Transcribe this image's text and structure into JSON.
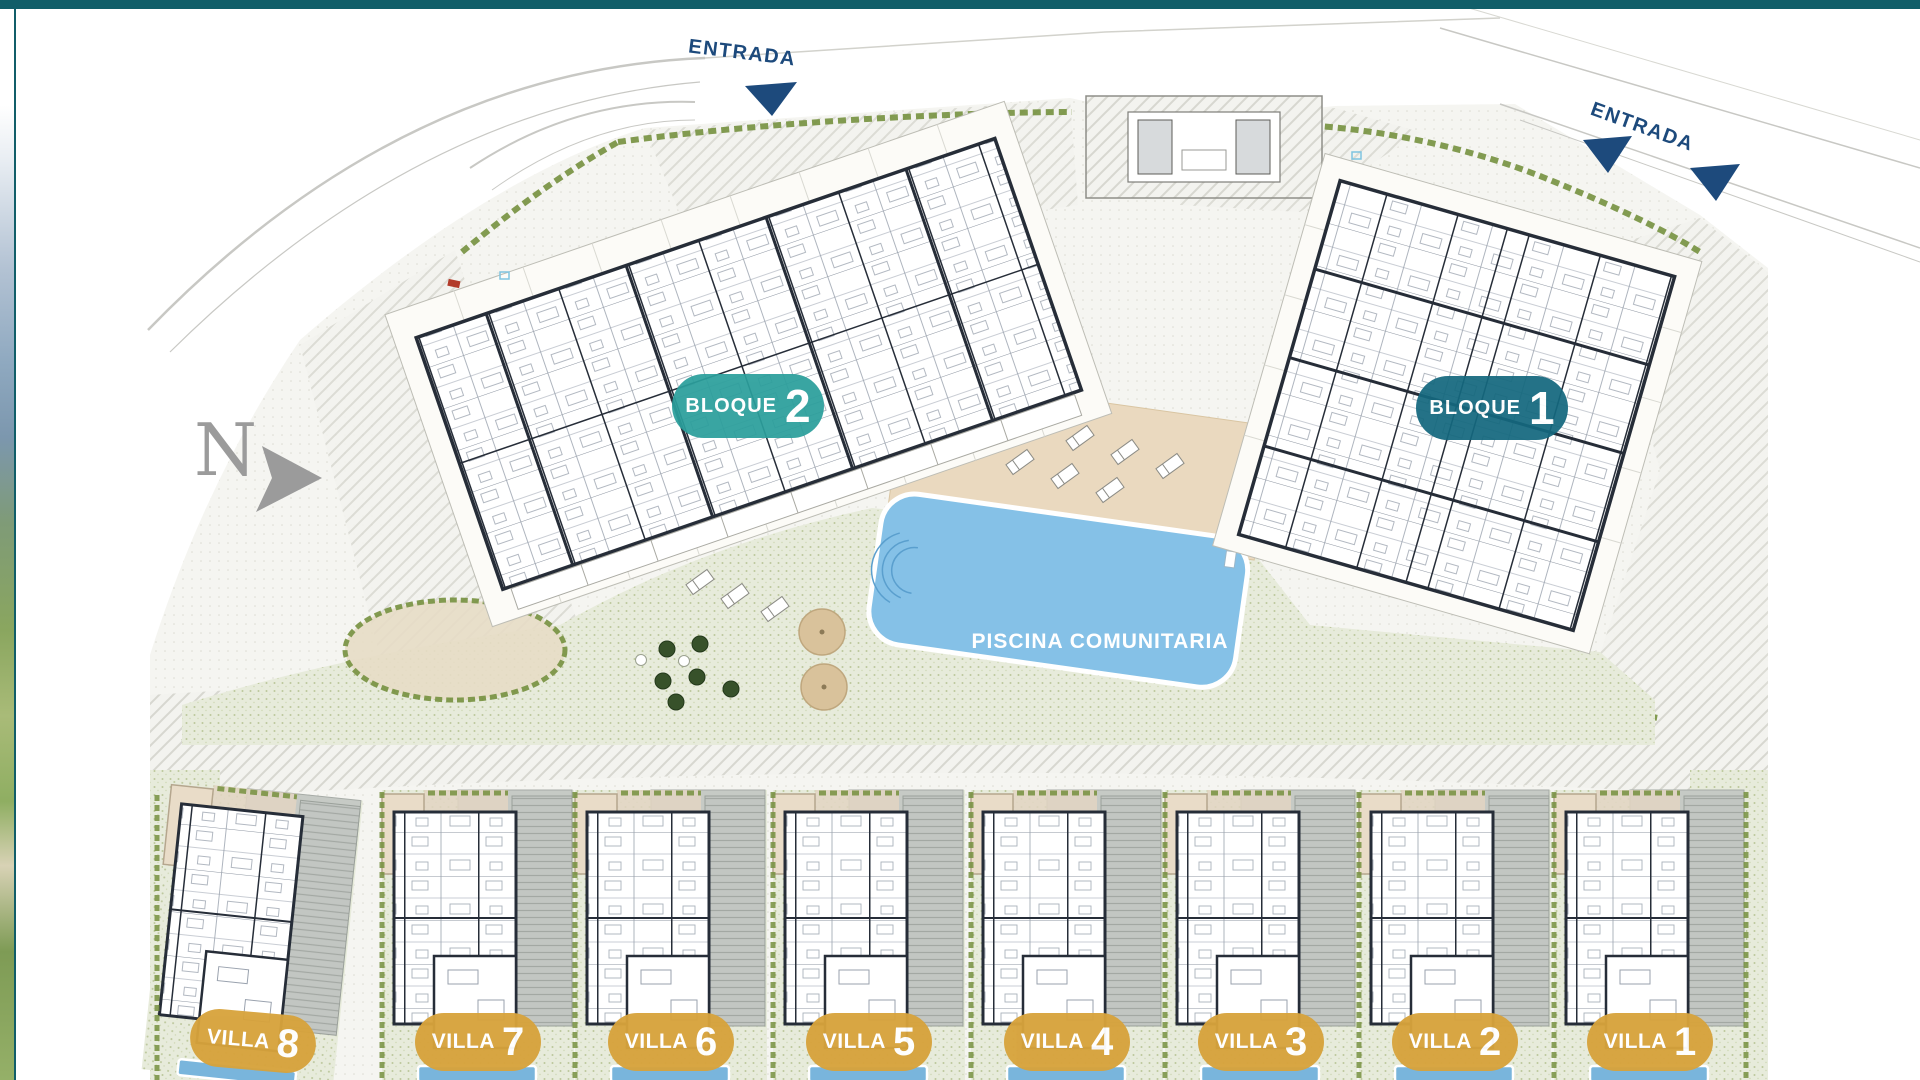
{
  "document": {
    "type": "residential development site plan",
    "top_bar_color": "#115e69"
  },
  "north_arrow": {
    "label": "N"
  },
  "entrances": [
    {
      "label": "ENTRADA"
    },
    {
      "label": "ENTRADA"
    }
  ],
  "blocks": [
    {
      "word": "BLOQUE",
      "number": "2",
      "badge_color": "#2b9f9c"
    },
    {
      "word": "BLOQUE",
      "number": "1",
      "badge_color": "#14687e"
    }
  ],
  "pool": {
    "label": "PISCINA COMUNITARIA",
    "water_color": "#85c1e7"
  },
  "villas": [
    {
      "word": "VILLA",
      "number": "8",
      "badge_color": "#d7a33c"
    },
    {
      "word": "VILLA",
      "number": "7",
      "badge_color": "#d7a33c"
    },
    {
      "word": "VILLA",
      "number": "6",
      "badge_color": "#d7a33c"
    },
    {
      "word": "VILLA",
      "number": "5",
      "badge_color": "#d7a33c"
    },
    {
      "word": "VILLA",
      "number": "4",
      "badge_color": "#d7a33c"
    },
    {
      "word": "VILLA",
      "number": "3",
      "badge_color": "#d7a33c"
    },
    {
      "word": "VILLA",
      "number": "2",
      "badge_color": "#d7a33c"
    },
    {
      "word": "VILLA",
      "number": "1",
      "badge_color": "#d7a33c"
    }
  ]
}
